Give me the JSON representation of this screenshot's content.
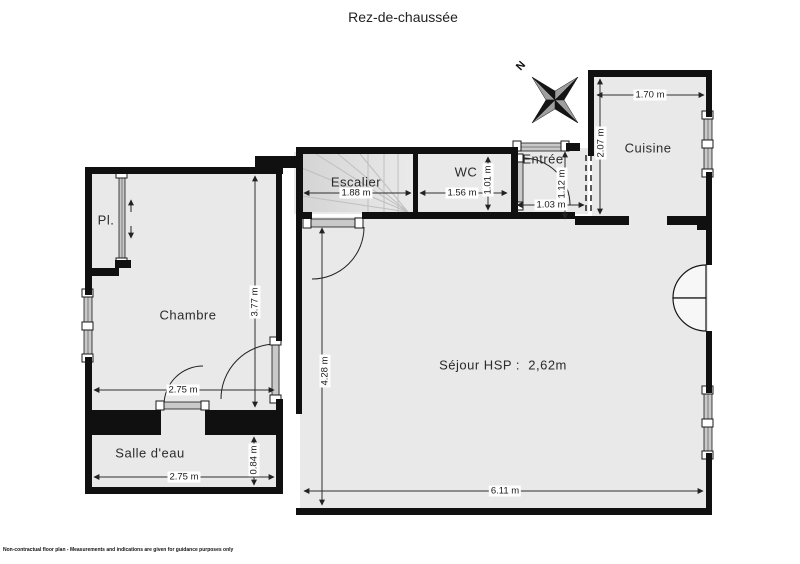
{
  "title": "Rez-de-chaussée",
  "compass": {
    "north": "N"
  },
  "rooms": {
    "escalier": {
      "name": "Escalier",
      "width": "1.88 m"
    },
    "wc": {
      "name": "WC",
      "width": "1.56 m",
      "depth": "1.01 m"
    },
    "entree": {
      "name": "Entrée",
      "width": "1.03 m",
      "depth": "1.12 m"
    },
    "cuisine": {
      "name": "Cuisine",
      "width": "1.70 m",
      "depth": "2.07 m"
    },
    "placard": {
      "name": "Pl."
    },
    "chambre": {
      "name": "Chambre",
      "width": "2.75 m",
      "depth": "3.77 m"
    },
    "salle_deau": {
      "name": "Salle d'eau",
      "width": "2.75 m",
      "depth": "0.84 m"
    },
    "sejour": {
      "name": "Séjour HSP :  2,62m",
      "width": "6.11 m",
      "depth": "4.28 m"
    }
  },
  "footer": {
    "disclaimer": "Non-contractual floor plan - Measurements and indications are given for guidance purposes only"
  },
  "colors": {
    "wall": "#101010",
    "floor": "#e9e9e9",
    "window_fill": "#c9c9c9",
    "background": "#ffffff"
  }
}
